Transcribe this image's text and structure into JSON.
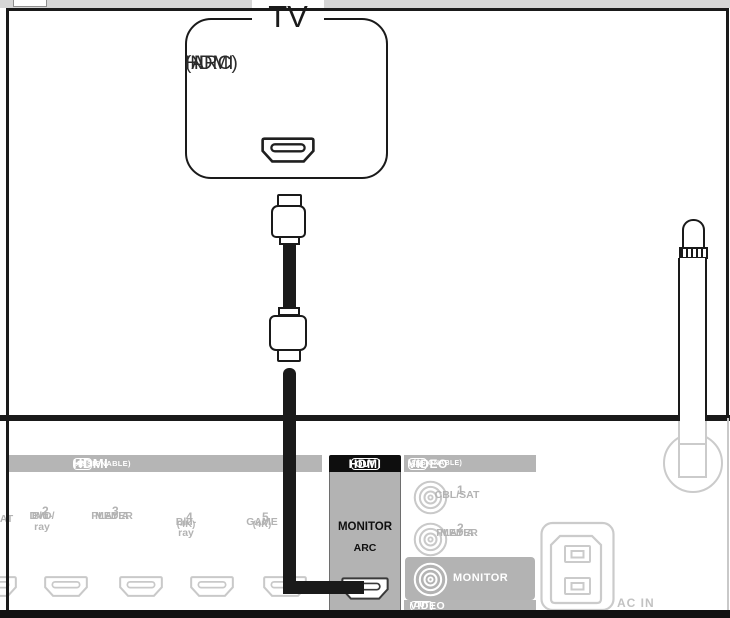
{
  "diagram": {
    "tv": {
      "title": "TV",
      "port_labels": [
        "HDMI",
        "IN",
        "(ARC)"
      ]
    },
    "rear_panel": {
      "hdmi_in": {
        "title": "HDMI",
        "badge": "IN",
        "note": "(ASSIGNABLE)",
        "inputs": [
          {
            "lines": [
              "SAT"
            ]
          },
          {
            "number": "2",
            "lines": [
              "DVD/",
              "Blu-ray"
            ]
          },
          {
            "number": "3",
            "lines": [
              "MEDIA",
              "PLAYER"
            ]
          },
          {
            "number": "4",
            "lines": [
              "Blu-ray"
            ],
            "sub": "(4K)"
          },
          {
            "number": "5",
            "lines": [
              "GAME"
            ],
            "sub": "(4K)"
          }
        ]
      },
      "hdmi_out": {
        "title": "HDMI",
        "badge": "OUT",
        "port_name": "MONITOR",
        "port_sub": "ARC"
      },
      "video": {
        "title": "VIDEO",
        "badge": "IN",
        "note": "(ASSIGNABLE)",
        "inputs": [
          {
            "number": "1",
            "lines": [
              "CBL/SAT"
            ]
          },
          {
            "number": "2",
            "lines": [
              "MEDIA",
              "PLAYER"
            ]
          }
        ],
        "monitor_label": "MONITOR",
        "out_title": "VIDEO",
        "out_badge": "OUT"
      },
      "ac_in_label": "AC IN"
    },
    "colors": {
      "line": "#1a1a1a",
      "grayed_text": "#b3b3b3",
      "outline_gray": "#c9c9c9",
      "bar_gray": "#b5b5b5",
      "hdmi_out_header": "#0e0e0e"
    }
  }
}
